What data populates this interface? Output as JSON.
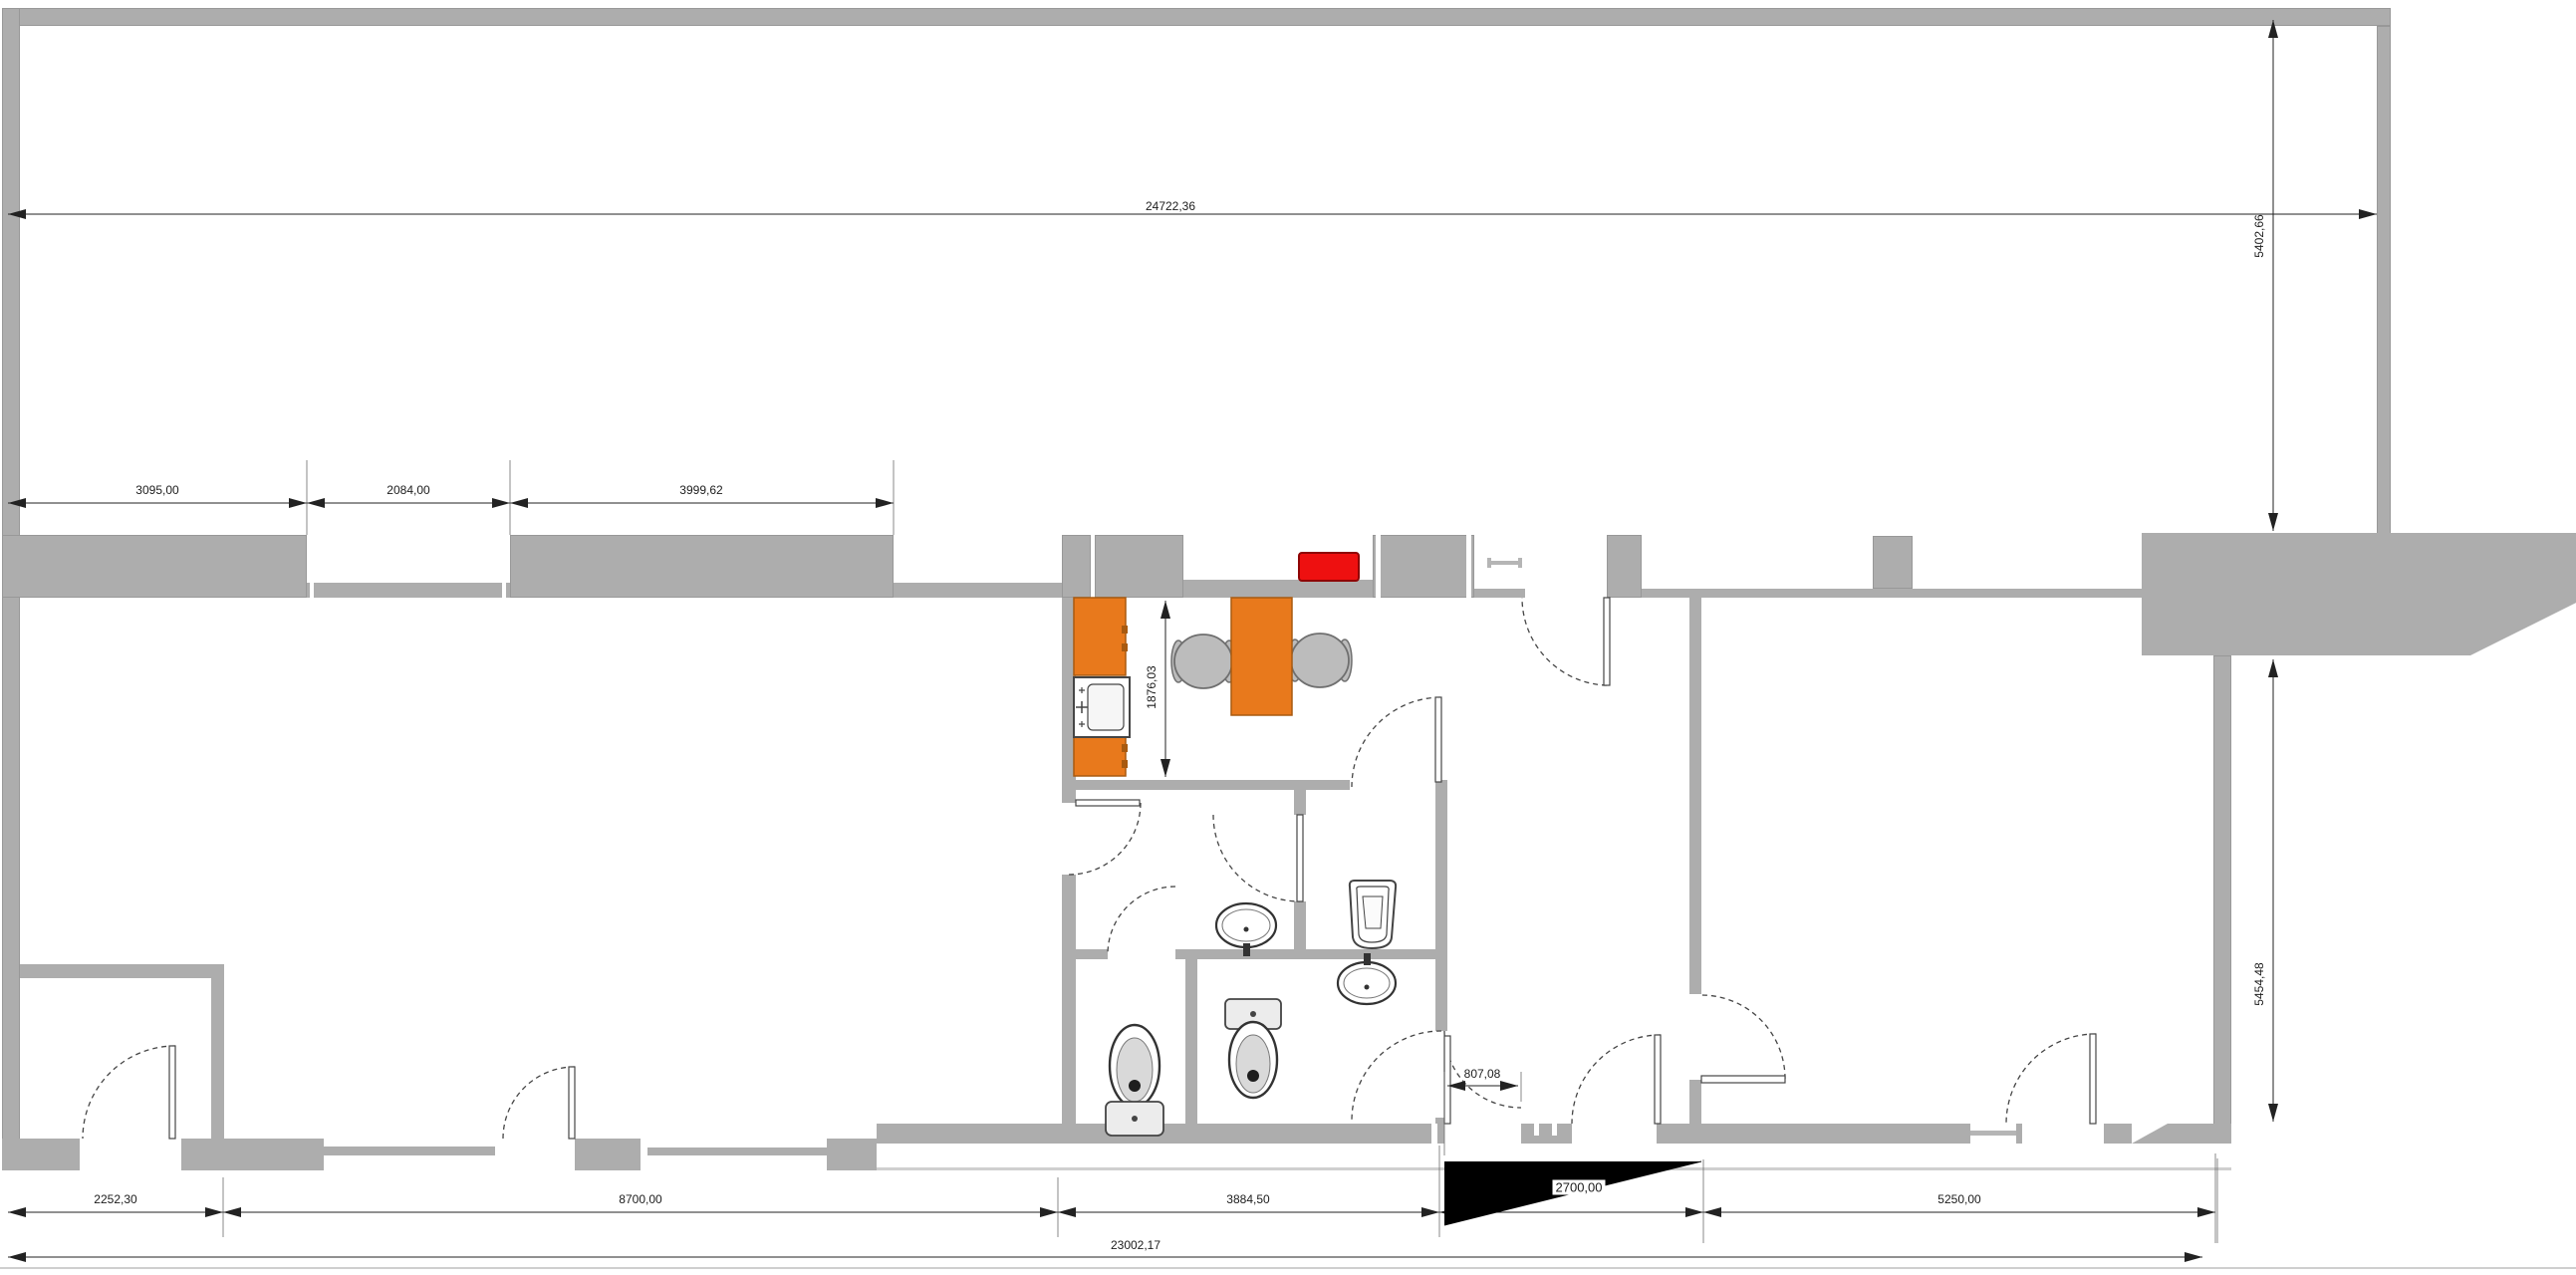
{
  "plan": {
    "title": "office-floor-plan",
    "dimensions": {
      "top_width": "24722,36",
      "upper_right_height": "5402,66",
      "left_wall_seg1": "3095,00",
      "left_wall_seg2": "2084,00",
      "left_wall_seg3": "3999,62",
      "kitchen_depth": "1876,03",
      "lower_right_height": "5454,48",
      "entry_door_width": "807,08",
      "bottom_seg1": "2252,30",
      "bottom_seg2": "8700,00",
      "bottom_seg3": "3884,50",
      "ramp_width": "2700,00",
      "bottom_seg4": "5250,00",
      "bottom_total": "23002,17"
    },
    "colors": {
      "wall": "#adadad",
      "wall-dark": "#989898",
      "furniture": "#e8791c",
      "furniture-border": "#a85a10",
      "appliance-red": "#ee1010",
      "appliance-red-border": "#8f0505",
      "chair": "#bcbcbc",
      "chair-border": "#6f6f6f",
      "fixture-line": "#454545",
      "dim-line": "#222222",
      "ramp": "#000000"
    },
    "fixtures": [
      "kitchen-cabinet",
      "kitchen-sink",
      "kitchen-cabinet",
      "desk",
      "office-chair",
      "office-chair",
      "red-appliance",
      "wash-basin",
      "wash-basin",
      "urinal",
      "toilet",
      "toilet",
      "entry-ramp"
    ]
  }
}
